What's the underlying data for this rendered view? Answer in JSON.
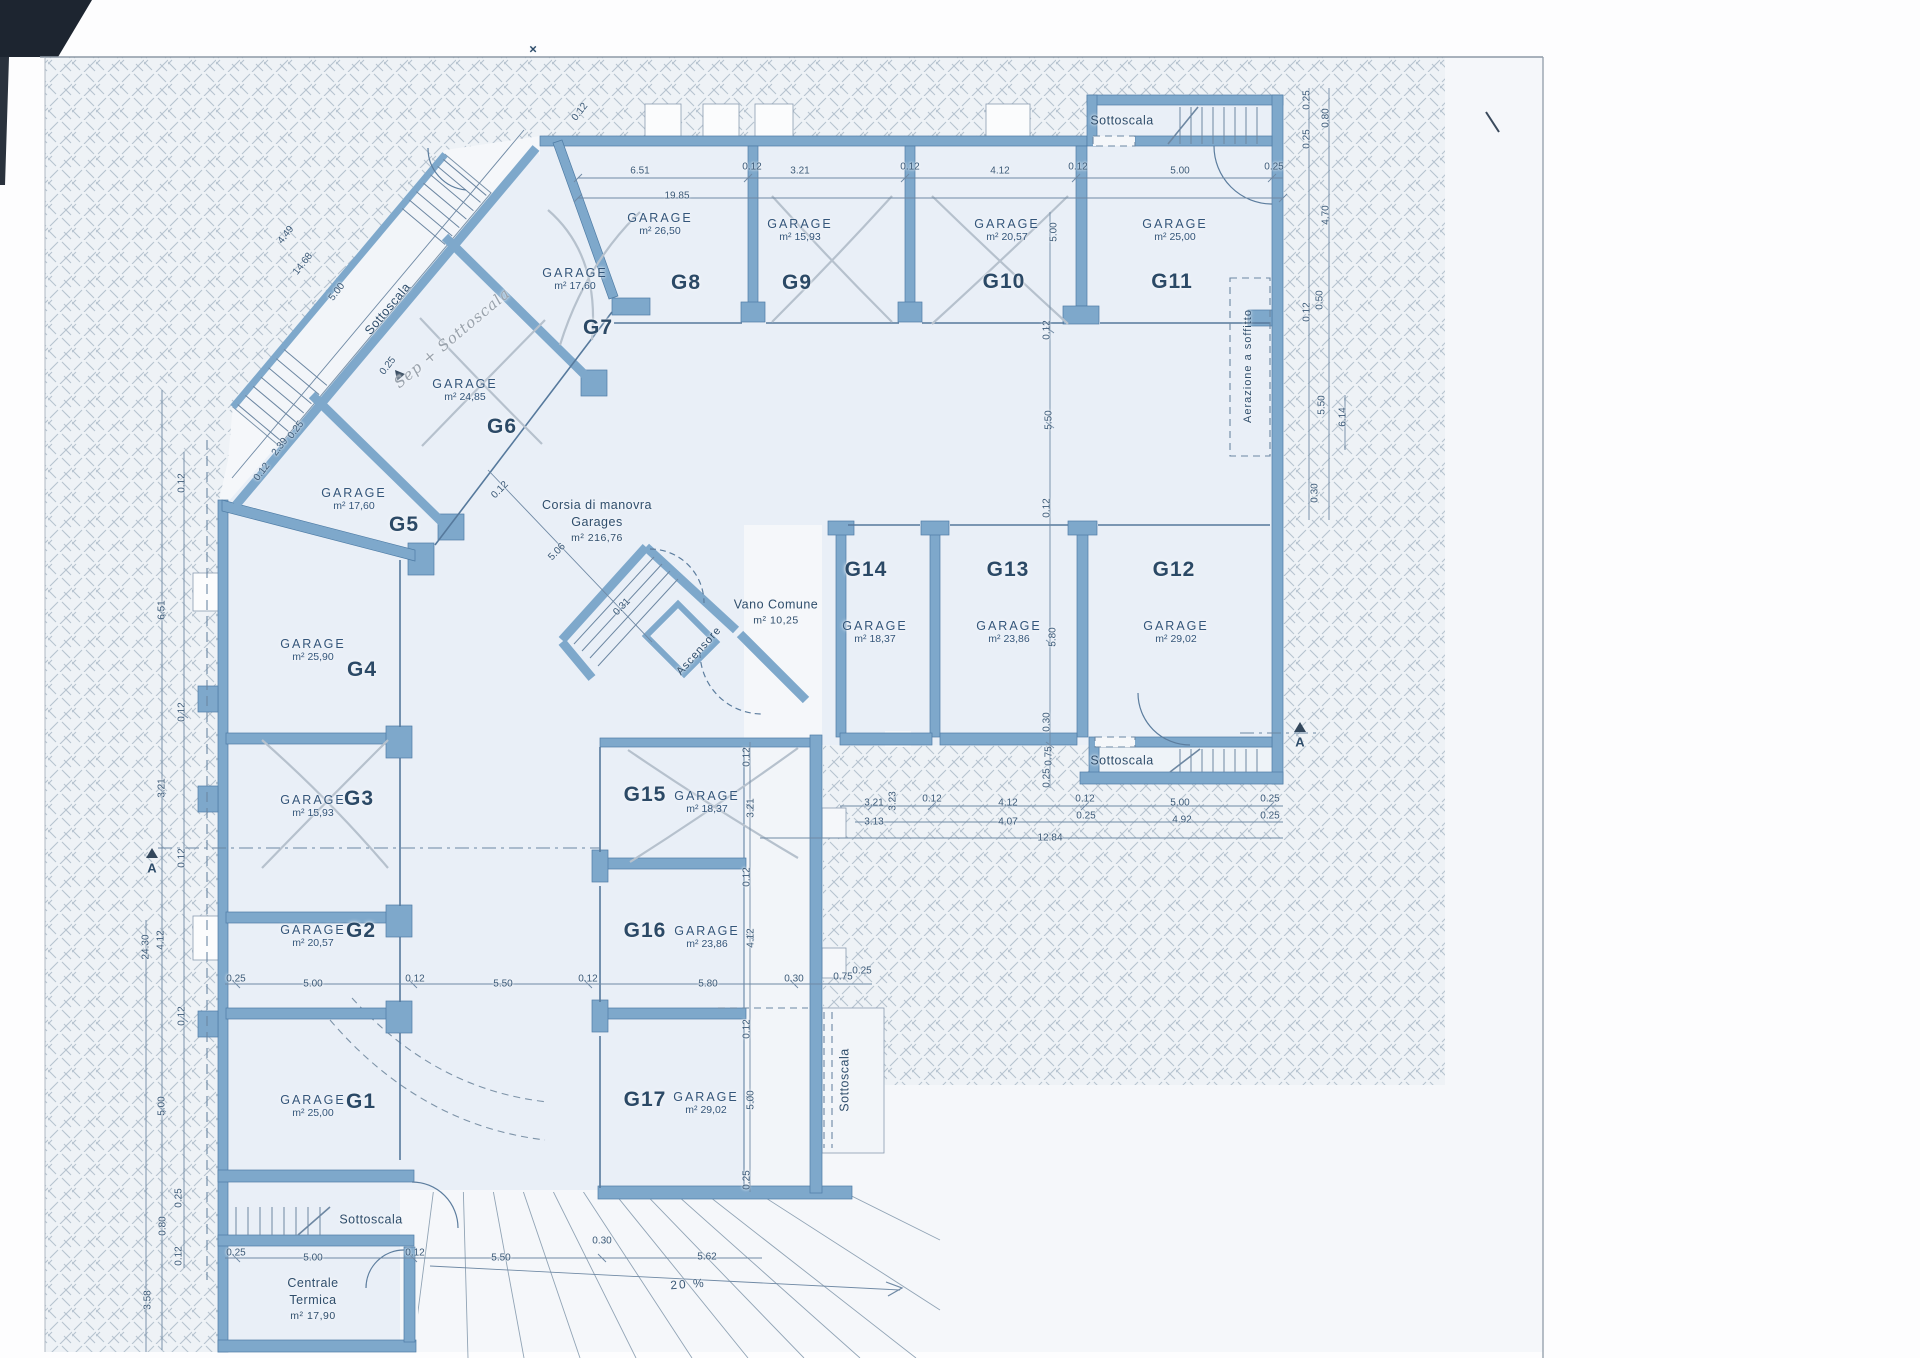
{
  "document": {
    "kind": "scanned architectural floor plan",
    "floor_use": "garage / basement level",
    "language": "Italian"
  },
  "colors": {
    "wall": "#7ea8cb",
    "wall_edge": "#4f7ca5",
    "paper_tint": "#f5f7fa",
    "room_fill": "#e9eff7",
    "ink": "#2e4d6b",
    "hatch_line": "#7e93a8"
  },
  "plan": {
    "drive_lane": {
      "label": "Corsia di manovra",
      "label2": "Garages",
      "area": "m² 216,76"
    },
    "rooms": [
      {
        "id": "G1",
        "label": "GARAGE",
        "area": "m² 25,00",
        "nx": 361,
        "ny": 1102,
        "ax": 313,
        "ay": 1106,
        "crossed": false
      },
      {
        "id": "G2",
        "label": "GARAGE",
        "area": "m² 20,57",
        "nx": 361,
        "ny": 931,
        "ax": 313,
        "ay": 936,
        "crossed": false
      },
      {
        "id": "G3",
        "label": "GARAGE",
        "area": "m² 15,93",
        "nx": 359,
        "ny": 799,
        "ax": 313,
        "ay": 806,
        "crossed": true
      },
      {
        "id": "G4",
        "label": "GARAGE",
        "area": "m² 25,90",
        "nx": 362,
        "ny": 670,
        "ax": 313,
        "ay": 650,
        "crossed": false
      },
      {
        "id": "G5",
        "label": "GARAGE",
        "area": "m² 17,60",
        "nx": 404,
        "ny": 525,
        "ax": 354,
        "ay": 499,
        "crossed": false
      },
      {
        "id": "G6",
        "label": "GARAGE",
        "area": "m² 24,85",
        "nx": 502,
        "ny": 427,
        "ax": 465,
        "ay": 390,
        "crossed": true
      },
      {
        "id": "G7",
        "label": "GARAGE",
        "area": "m² 17,60",
        "nx": 598,
        "ny": 328,
        "ax": 575,
        "ay": 279,
        "crossed": false
      },
      {
        "id": "G8",
        "label": "GARAGE",
        "area": "m² 26,50",
        "nx": 686,
        "ny": 283,
        "ax": 660,
        "ay": 224,
        "crossed": false
      },
      {
        "id": "G9",
        "label": "GARAGE",
        "area": "m² 15,93",
        "nx": 797,
        "ny": 283,
        "ax": 800,
        "ay": 230,
        "crossed": true
      },
      {
        "id": "G10",
        "label": "GARAGE",
        "area": "m² 20,57",
        "nx": 1004,
        "ny": 282,
        "ax": 1007,
        "ay": 230,
        "crossed": true
      },
      {
        "id": "G11",
        "label": "GARAGE",
        "area": "m² 25,00",
        "nx": 1172,
        "ny": 282,
        "ax": 1175,
        "ay": 230,
        "crossed": false
      },
      {
        "id": "G12",
        "label": "GARAGE",
        "area": "m² 29,02",
        "nx": 1174,
        "ny": 570,
        "ax": 1176,
        "ay": 632,
        "crossed": false
      },
      {
        "id": "G13",
        "label": "GARAGE",
        "area": "m² 23,86",
        "nx": 1008,
        "ny": 570,
        "ax": 1009,
        "ay": 632,
        "crossed": false
      },
      {
        "id": "G14",
        "label": "GARAGE",
        "area": "m² 18,37",
        "nx": 866,
        "ny": 570,
        "ax": 875,
        "ay": 632,
        "crossed": false
      },
      {
        "id": "G15",
        "label": "GARAGE",
        "area": "m² 18,37",
        "nx": 645,
        "ny": 795,
        "ax": 707,
        "ay": 802,
        "crossed": true
      },
      {
        "id": "G16",
        "label": "GARAGE",
        "area": "m² 23,86",
        "nx": 645,
        "ny": 931,
        "ax": 707,
        "ay": 937,
        "crossed": false
      },
      {
        "id": "G17",
        "label": "GARAGE",
        "area": "m² 29,02",
        "nx": 645,
        "ny": 1100,
        "ax": 706,
        "ay": 1103,
        "crossed": false
      }
    ],
    "texts": [
      {
        "name": "sottoscala-top-right",
        "lines": [
          "Sottoscala"
        ],
        "x": 1122,
        "y": 121,
        "r": 0,
        "cls": "space-l"
      },
      {
        "name": "sottoscala-diagonal",
        "lines": [
          "Sottoscala"
        ],
        "x": 388,
        "y": 309,
        "r": -50,
        "cls": "space-l"
      },
      {
        "name": "sottoscala-right",
        "lines": [
          "Sottoscala"
        ],
        "x": 1122,
        "y": 761,
        "r": 0,
        "cls": "space-l"
      },
      {
        "name": "sottoscala-bottom-left",
        "lines": [
          "Sottoscala"
        ],
        "x": 371,
        "y": 1220,
        "r": 0,
        "cls": "space-l"
      },
      {
        "name": "sottoscala-vertical",
        "lines": [
          "Sottoscala"
        ],
        "x": 845,
        "y": 1080,
        "r": -90,
        "cls": "space-l"
      },
      {
        "name": "vano-comune",
        "lines": [
          "Vano Comune",
          "m² 10,25"
        ],
        "x": 776,
        "y": 612,
        "r": 0,
        "cls": "space-l"
      },
      {
        "name": "ascensore",
        "lines": [
          "Ascensore"
        ],
        "x": 699,
        "y": 651,
        "r": -48,
        "cls": "small-l"
      },
      {
        "name": "centrale-termica",
        "lines": [
          "Centrale",
          "Termica",
          "m² 17,90"
        ],
        "x": 313,
        "y": 1299,
        "r": 0,
        "cls": "space-l"
      },
      {
        "name": "corsia-di-manovra",
        "lines": [
          "Corsia di manovra",
          "Garages",
          "m² 216,76"
        ],
        "x": 597,
        "y": 521,
        "r": 0,
        "cls": "space-l"
      },
      {
        "name": "aerazione-soffitto",
        "lines": [
          "Aerazione a soffitto"
        ],
        "x": 1248,
        "y": 366,
        "r": -90,
        "cls": "small-l"
      },
      {
        "name": "handwritten-note",
        "lines": [
          "Sep + Sottoscala"
        ],
        "x": 452,
        "y": 338,
        "r": -40,
        "cls": "hand-l"
      }
    ],
    "dims": [
      {
        "t": "6.51",
        "x": 640,
        "y": 171
      },
      {
        "t": "0.12",
        "x": 752,
        "y": 167
      },
      {
        "t": "3.21",
        "x": 800,
        "y": 171
      },
      {
        "t": "0.12",
        "x": 910,
        "y": 167
      },
      {
        "t": "4.12",
        "x": 1000,
        "y": 171
      },
      {
        "t": "0.12",
        "x": 1078,
        "y": 167
      },
      {
        "t": "5.00",
        "x": 1180,
        "y": 171
      },
      {
        "t": "0.25",
        "x": 1274,
        "y": 167
      },
      {
        "t": "19.85",
        "x": 677,
        "y": 196
      },
      {
        "t": "5.00",
        "x": 1054,
        "y": 232,
        "r": -90
      },
      {
        "t": "0.12",
        "x": 1047,
        "y": 330,
        "r": -90
      },
      {
        "t": "5.50",
        "x": 1049,
        "y": 420,
        "r": -90
      },
      {
        "t": "0.12",
        "x": 1047,
        "y": 508,
        "r": -90
      },
      {
        "t": "5.80",
        "x": 1053,
        "y": 637,
        "r": -90
      },
      {
        "t": "0.30",
        "x": 1047,
        "y": 722,
        "r": -90
      },
      {
        "t": "0.75",
        "x": 1049,
        "y": 756,
        "r": -90
      },
      {
        "t": "0.25",
        "x": 1047,
        "y": 778,
        "r": -90
      },
      {
        "t": "3.21",
        "x": 874,
        "y": 803
      },
      {
        "t": "0.12",
        "x": 932,
        "y": 799
      },
      {
        "t": "4.12",
        "x": 1008,
        "y": 803
      },
      {
        "t": "0.12",
        "x": 1085,
        "y": 799
      },
      {
        "t": "5.00",
        "x": 1180,
        "y": 803
      },
      {
        "t": "0.25",
        "x": 1270,
        "y": 799
      },
      {
        "t": "3.13",
        "x": 874,
        "y": 822
      },
      {
        "t": "4.07",
        "x": 1008,
        "y": 822
      },
      {
        "t": "4.92",
        "x": 1182,
        "y": 820
      },
      {
        "t": "0.25",
        "x": 1086,
        "y": 816
      },
      {
        "t": "0.25",
        "x": 1270,
        "y": 816
      },
      {
        "t": "12.84",
        "x": 1050,
        "y": 838
      },
      {
        "t": "3.23",
        "x": 893,
        "y": 801,
        "r": -90
      },
      {
        "t": "0.12",
        "x": 182,
        "y": 483,
        "r": -90
      },
      {
        "t": "6.51",
        "x": 162,
        "y": 610,
        "r": -90
      },
      {
        "t": "0.12",
        "x": 182,
        "y": 712,
        "r": -90
      },
      {
        "t": "3.21",
        "x": 162,
        "y": 788,
        "r": -90
      },
      {
        "t": "0.12",
        "x": 182,
        "y": 858,
        "r": -90
      },
      {
        "t": "24.30",
        "x": 146,
        "y": 947,
        "r": -90
      },
      {
        "t": "4.12",
        "x": 161,
        "y": 940,
        "r": -90
      },
      {
        "t": "0.12",
        "x": 182,
        "y": 1016,
        "r": -90
      },
      {
        "t": "5.00",
        "x": 162,
        "y": 1106,
        "r": -90
      },
      {
        "t": "0.25",
        "x": 179,
        "y": 1198,
        "r": -90
      },
      {
        "t": "0.80",
        "x": 163,
        "y": 1226,
        "r": -90
      },
      {
        "t": "0.12",
        "x": 179,
        "y": 1256,
        "r": -90
      },
      {
        "t": "3.58",
        "x": 148,
        "y": 1300,
        "r": -90
      },
      {
        "t": "0.25",
        "x": 236,
        "y": 979
      },
      {
        "t": "5.00",
        "x": 313,
        "y": 984
      },
      {
        "t": "0.12",
        "x": 415,
        "y": 979
      },
      {
        "t": "5.50",
        "x": 503,
        "y": 984
      },
      {
        "t": "0.12",
        "x": 588,
        "y": 979
      },
      {
        "t": "5.80",
        "x": 708,
        "y": 984
      },
      {
        "t": "0.30",
        "x": 794,
        "y": 979
      },
      {
        "t": "0.75",
        "x": 843,
        "y": 977
      },
      {
        "t": "0.25",
        "x": 862,
        "y": 971
      },
      {
        "t": "0.12",
        "x": 747,
        "y": 757,
        "r": -90
      },
      {
        "t": "3.21",
        "x": 751,
        "y": 808,
        "r": -90
      },
      {
        "t": "0.12",
        "x": 747,
        "y": 877,
        "r": -90
      },
      {
        "t": "4.12",
        "x": 751,
        "y": 938,
        "r": -90
      },
      {
        "t": "0.12",
        "x": 747,
        "y": 1029,
        "r": -90
      },
      {
        "t": "5.00",
        "x": 751,
        "y": 1100,
        "r": -90
      },
      {
        "t": "0.25",
        "x": 747,
        "y": 1180,
        "r": -90
      },
      {
        "t": "0.25",
        "x": 236,
        "y": 1253
      },
      {
        "t": "5.00",
        "x": 313,
        "y": 1258
      },
      {
        "t": "0.12",
        "x": 415,
        "y": 1253
      },
      {
        "t": "5.50",
        "x": 501,
        "y": 1258
      },
      {
        "t": "0.30",
        "x": 602,
        "y": 1241
      },
      {
        "t": "5.62",
        "x": 707,
        "y": 1257
      },
      {
        "t": "0.25",
        "x": 1307,
        "y": 100,
        "r": -90
      },
      {
        "t": "0.80",
        "x": 1326,
        "y": 118,
        "r": -90
      },
      {
        "t": "0.25",
        "x": 1307,
        "y": 139,
        "r": -90
      },
      {
        "t": "4.70",
        "x": 1326,
        "y": 215,
        "r": -90
      },
      {
        "t": "0.50",
        "x": 1320,
        "y": 300,
        "r": -90
      },
      {
        "t": "0.12",
        "x": 1307,
        "y": 312,
        "r": -90
      },
      {
        "t": "5.50",
        "x": 1322,
        "y": 405,
        "r": -90
      },
      {
        "t": "6.14",
        "x": 1343,
        "y": 417,
        "r": -90
      },
      {
        "t": "0.30",
        "x": 1315,
        "y": 493,
        "r": -90
      },
      {
        "t": "0.12",
        "x": 580,
        "y": 112,
        "r": -52
      },
      {
        "t": "4.49",
        "x": 286,
        "y": 235,
        "r": -52
      },
      {
        "t": "14.68",
        "x": 303,
        "y": 264,
        "r": -52
      },
      {
        "t": "5.00",
        "x": 337,
        "y": 292,
        "r": -52
      },
      {
        "t": "0.25",
        "x": 388,
        "y": 366,
        "r": -52
      },
      {
        "t": "2.39",
        "x": 280,
        "y": 447,
        "r": -52
      },
      {
        "t": "0.25",
        "x": 296,
        "y": 430,
        "r": -52
      },
      {
        "t": "0.12",
        "x": 262,
        "y": 472,
        "r": -52
      },
      {
        "t": "0.12",
        "x": 500,
        "y": 490,
        "r": -46
      },
      {
        "t": "5.06",
        "x": 557,
        "y": 552,
        "r": -46
      },
      {
        "t": "0.31",
        "x": 622,
        "y": 607,
        "r": -46
      }
    ],
    "markers": [
      {
        "t": "A",
        "x": 152,
        "y": 868,
        "cls": "marker",
        "name": "section-marker-a-left"
      },
      {
        "t": "A",
        "x": 1300,
        "y": 742,
        "cls": "marker",
        "name": "section-marker-a-right"
      },
      {
        "t": "×",
        "x": 533,
        "y": 49,
        "cls": "marker",
        "name": "top-reference-mark"
      },
      {
        "t": "20 %",
        "x": 688,
        "y": 1284,
        "r": -4,
        "cls": "pct",
        "name": "ramp-slope-label"
      }
    ]
  }
}
